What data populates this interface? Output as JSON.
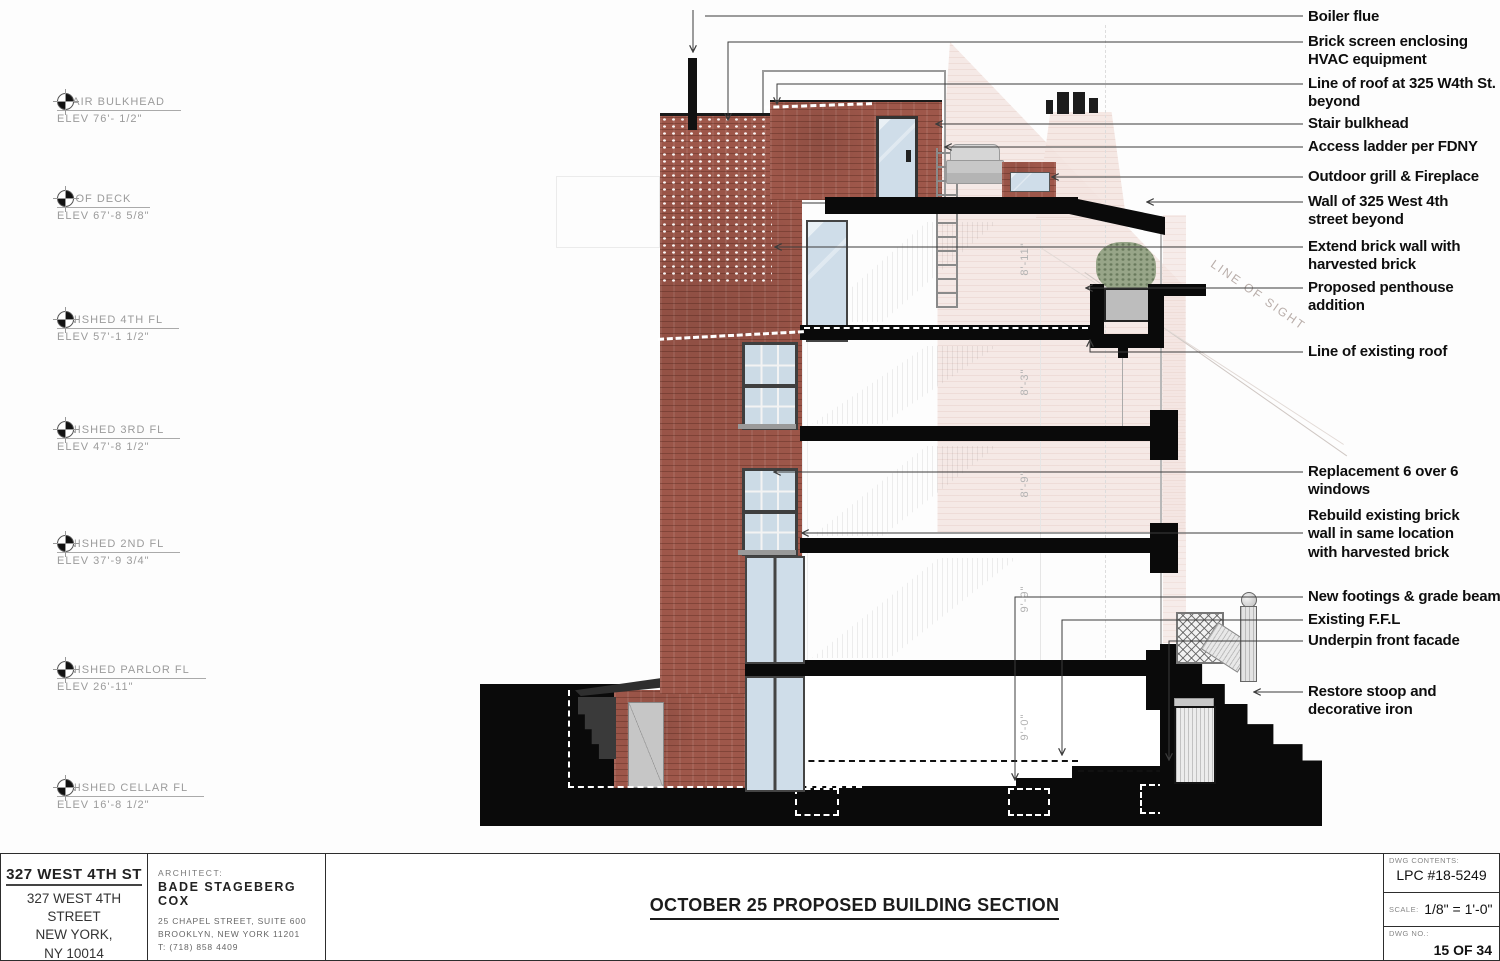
{
  "palette": {
    "brick": "#9e574a",
    "beyond_pink": "#f4e6e2",
    "glass_blue": "#cfdde9",
    "section_poche": "#0a0a0a",
    "stair_gray": "#e3e3e3",
    "leader_line": "#3c3c3c",
    "marker_text_gray": "#9b9b9b",
    "dimension_text_gray": "#b3b3b3"
  },
  "elevation_markers": [
    {
      "name": "STAIR BULKHEAD",
      "elev": "ELEV 76'- 1/2\""
    },
    {
      "name": "ROOF DECK",
      "elev": "ELEV 67'-8 5/8\""
    },
    {
      "name": "FINISHED 4TH FL",
      "elev": "ELEV 57'-1 1/2\""
    },
    {
      "name": "FINISHED 3RD FL",
      "elev": "ELEV 47'-8 1/2\""
    },
    {
      "name": "FINISHED 2ND FL",
      "elev": "ELEV 37'-9 3/4\""
    },
    {
      "name": "FINISHED PARLOR FL",
      "elev": "ELEV 26'-11\""
    },
    {
      "name": "FINISHED CELLAR FL",
      "elev": "ELEV 16'-8 1/2\""
    }
  ],
  "annotations": [
    {
      "label": "Boiler flue"
    },
    {
      "label": "Brick screen enclosing\nHVAC equipment"
    },
    {
      "label": "Line of roof at 325 W4th St.\nbeyond"
    },
    {
      "label": "Stair bulkhead"
    },
    {
      "label": "Access ladder per FDNY"
    },
    {
      "label": "Outdoor grill & Fireplace"
    },
    {
      "label": "Wall of 325 West 4th\nstreet beyond"
    },
    {
      "label": "Extend brick wall with\nharvested brick"
    },
    {
      "label": "Proposed penthouse\naddition"
    },
    {
      "label": "Line of existing roof"
    },
    {
      "label": "Replacement 6 over 6\nwindows"
    },
    {
      "label": "Rebuild existing brick\nwall in same location\nwith harvested brick"
    },
    {
      "label": "New footings & grade beam"
    },
    {
      "label": "Existing F.F.L"
    },
    {
      "label": "Underpin front facade"
    },
    {
      "label": "Restore stoop and\ndecorative iron"
    }
  ],
  "dimensions": [
    {
      "value": "8'-11\""
    },
    {
      "value": "8'-3\""
    },
    {
      "value": "8'-9\""
    },
    {
      "value": "9'-9\""
    },
    {
      "value": "9'-0\""
    }
  ],
  "drawing_labels": {
    "line_of_sight": "LINE OF SIGHT"
  },
  "title_block": {
    "project_name": "327 WEST 4TH ST",
    "address_lines": [
      "327 WEST 4TH",
      "STREET",
      "NEW YORK,",
      "NY 10014"
    ],
    "architect_label": "ARCHITECT:",
    "architect_name": "BADE STAGEBERG COX",
    "architect_address_1": "25 CHAPEL STREET, SUITE 600",
    "architect_address_2": "BROOKLYN, NEW YORK 11201",
    "architect_phone": "T: (718) 858 4409",
    "drawing_title": "OCTOBER 25 PROPOSED BUILDING SECTION",
    "dwg_contents_label": "DWG CONTENTS:",
    "dwg_contents": "LPC #18-5249",
    "scale_label": "SCALE:",
    "scale": "1/8\" = 1'-0\"",
    "dwg_no_label": "DWG NO.:",
    "dwg_no": "15 OF 34"
  }
}
